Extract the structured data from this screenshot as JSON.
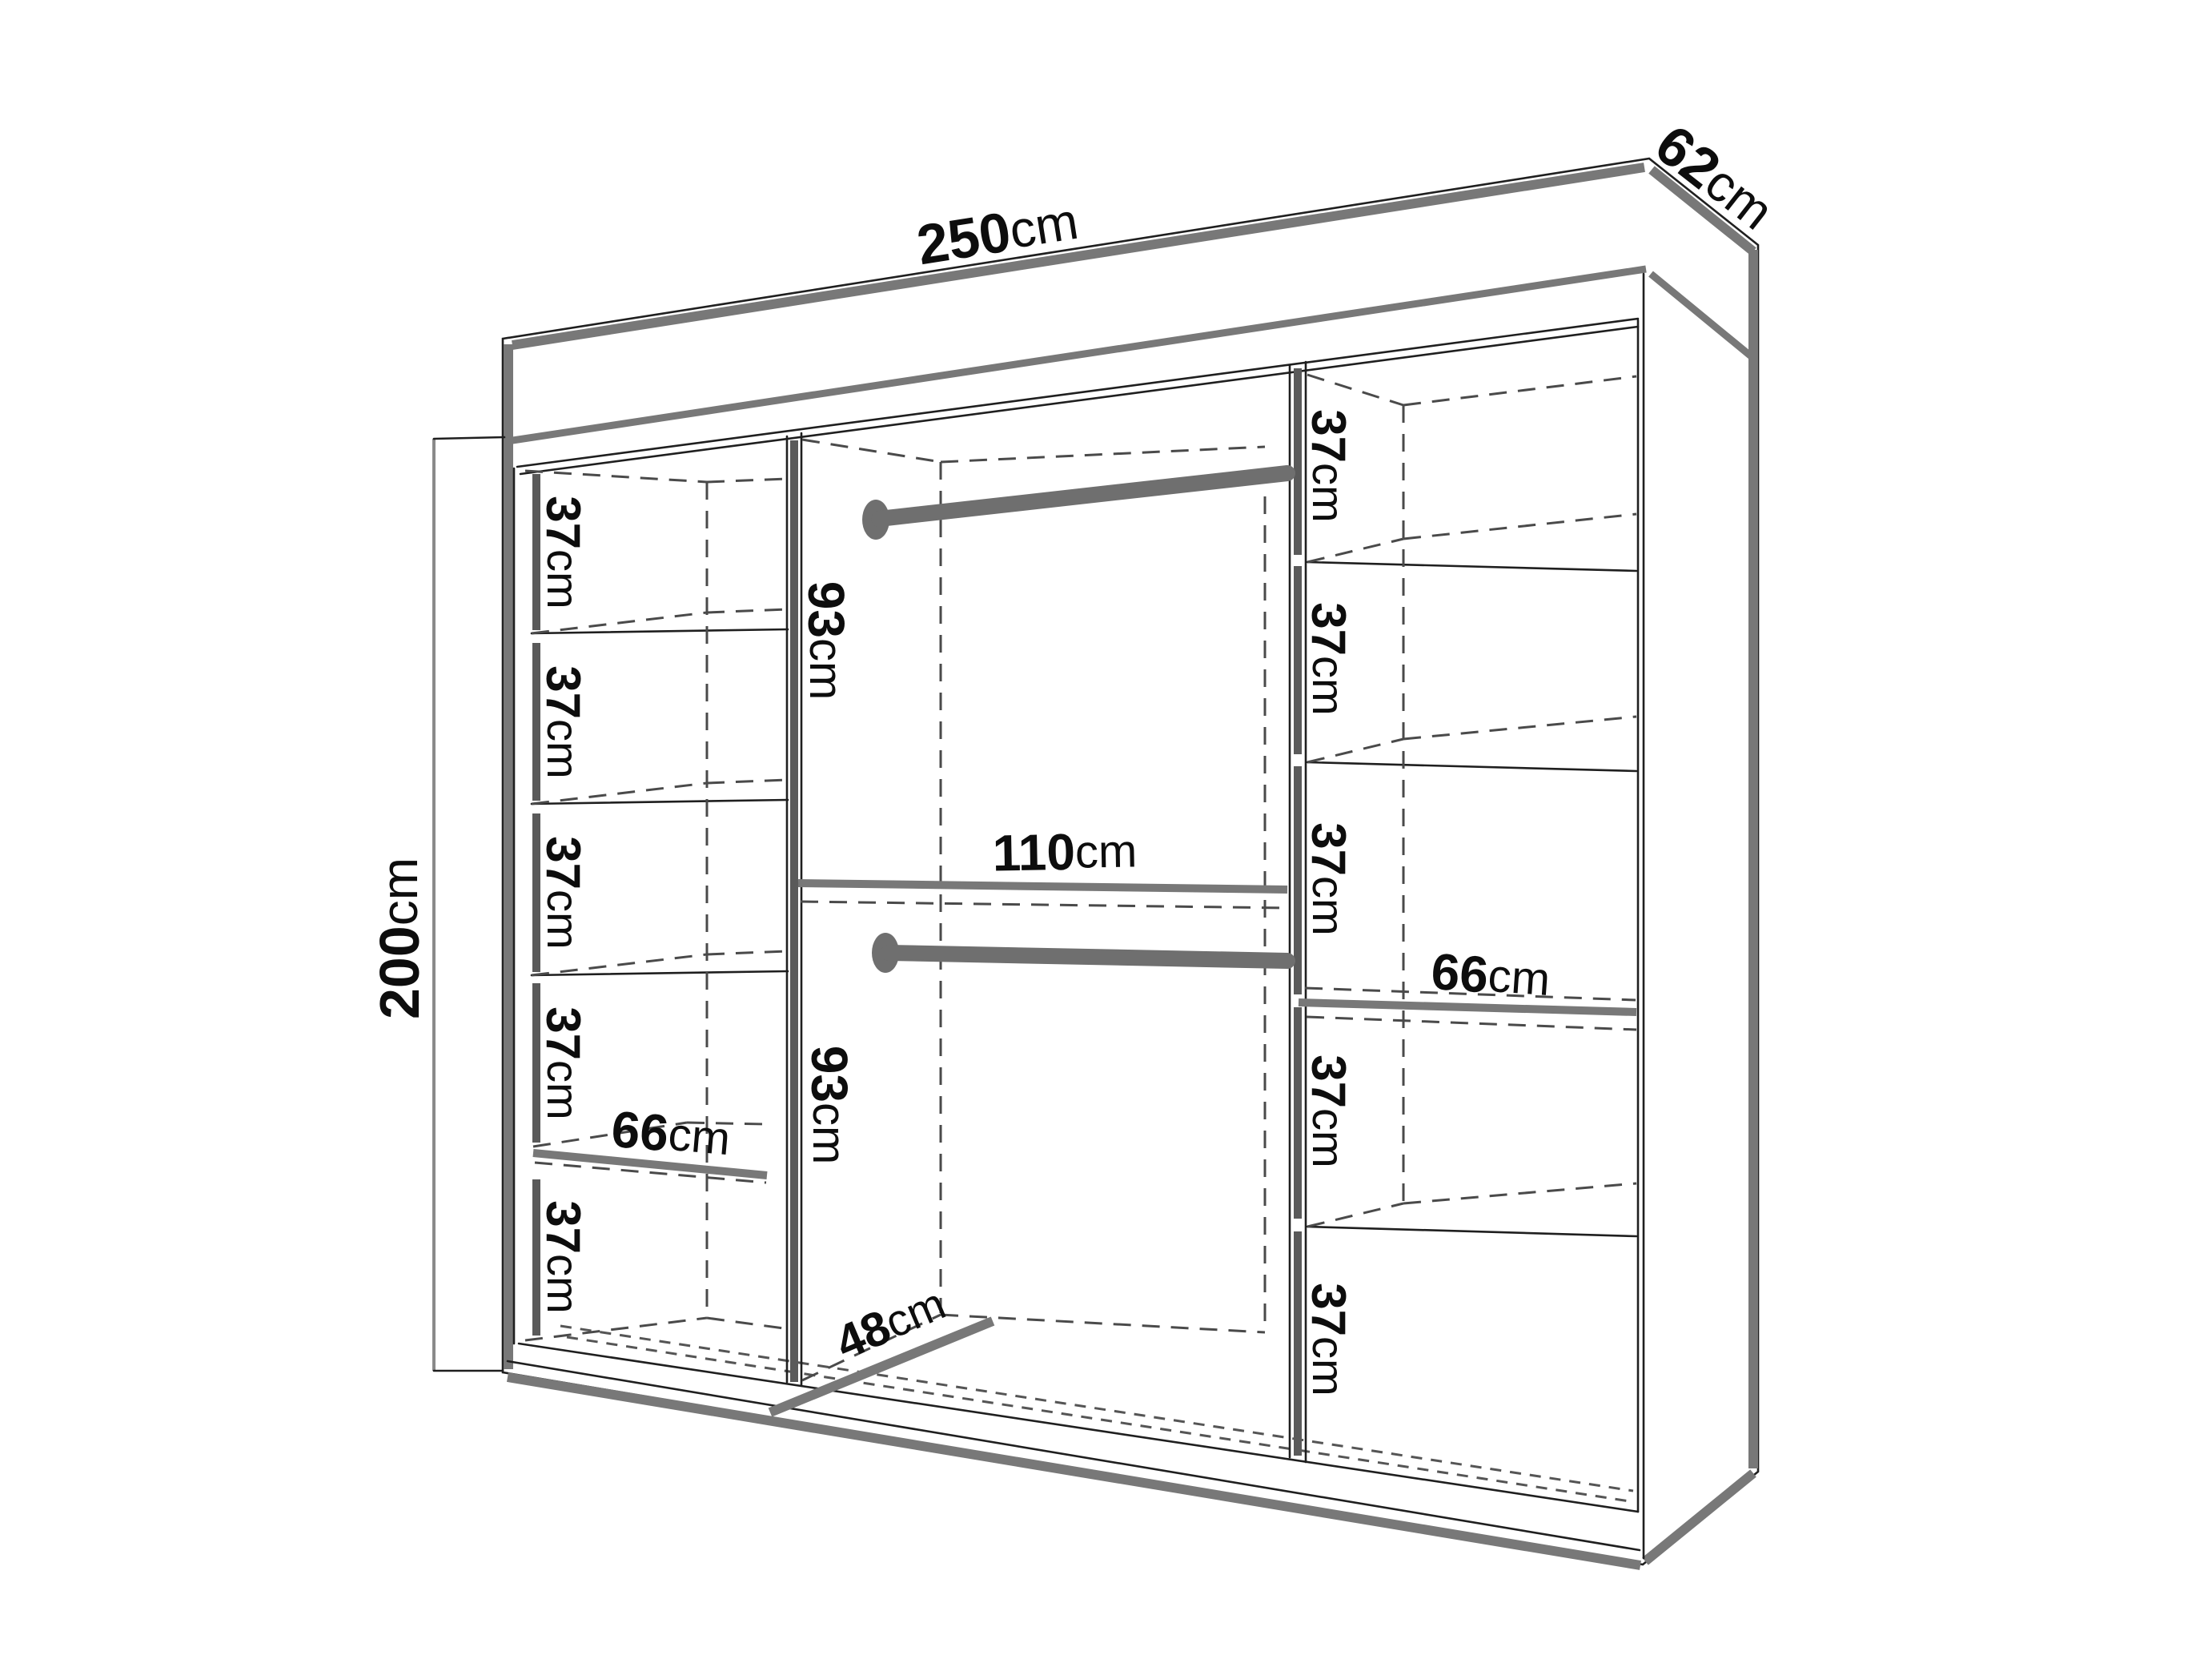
{
  "wardrobe": {
    "description": "Sliding wardrobe interior dimension diagram",
    "overall": {
      "width": {
        "value": "250",
        "unit": "cm"
      },
      "depth": {
        "value": "62",
        "unit": "cm"
      },
      "height": {
        "value": "200",
        "unit": "cm"
      }
    },
    "left_shelves": [
      {
        "value": "37",
        "unit": "cm"
      },
      {
        "value": "37",
        "unit": "cm"
      },
      {
        "value": "37",
        "unit": "cm"
      },
      {
        "value": "37",
        "unit": "cm"
      },
      {
        "value": "37",
        "unit": "cm"
      }
    ],
    "left_shelf_width": {
      "value": "66",
      "unit": "cm"
    },
    "right_shelves": [
      {
        "value": "37",
        "unit": "cm"
      },
      {
        "value": "37",
        "unit": "cm"
      },
      {
        "value": "37",
        "unit": "cm"
      },
      {
        "value": "37",
        "unit": "cm"
      },
      {
        "value": "37",
        "unit": "cm"
      }
    ],
    "right_shelf_width": {
      "value": "66",
      "unit": "cm"
    },
    "middle": {
      "upper_height": {
        "value": "93",
        "unit": "cm"
      },
      "lower_height": {
        "value": "93",
        "unit": "cm"
      },
      "width": {
        "value": "110",
        "unit": "cm"
      },
      "depth": {
        "value": "48",
        "unit": "cm"
      }
    },
    "colors": {
      "background": "#ffffff",
      "outline": "#1f1f1f",
      "accent_gray": "#787878",
      "bar_gray": "#5a5a5a",
      "rod_gray": "#6f6f6f",
      "dash_gray": "#4a4a4a",
      "text": "#0d0d0d"
    }
  }
}
